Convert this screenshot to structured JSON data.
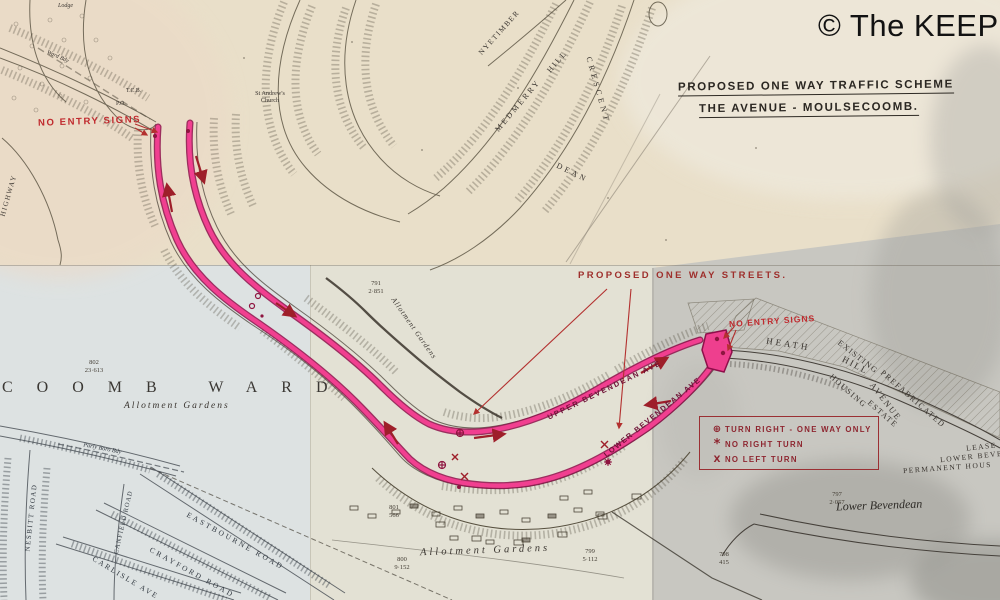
{
  "watermark": {
    "text": "© The KEEP"
  },
  "title": {
    "line1": "PROPOSED ONE WAY TRAFFIC SCHEME",
    "line2": "THE AVENUE - MOULSECOOMB."
  },
  "annotations": {
    "no_entry_left": "NO ENTRY SIGNS",
    "no_entry_right": "NO ENTRY SIGNS",
    "proposed_streets": "PROPOSED ONE WAY STREETS.",
    "route_upper": "UPPER BEVENDEAN AVE",
    "route_lower": "LOWER BEVENDEAN AVE"
  },
  "legend": {
    "items": [
      {
        "symbol": "⊕",
        "label": "TURN RIGHT - ONE WAY ONLY"
      },
      {
        "symbol": "*",
        "label": "NO RIGHT TURN"
      },
      {
        "symbol": "X",
        "label": "NO LEFT TURN"
      }
    ]
  },
  "map_labels": {
    "ward": "COOMB WARD",
    "allotment_ward": "Allotment Gardens",
    "allotment_bottom": "Allotment Gardens",
    "allotment_mid": "Allotment Gardens",
    "lower_bevendean": "Lower Bevendean",
    "permanent_housing": "PERMANENT HOUS",
    "lower_bev_partial": "LOWER BEVE",
    "lease_partial": "LEASE",
    "heath": "HEATH",
    "hill2": "HILL",
    "avenue": "AVENUE",
    "existing": "EXISTING",
    "prefabricated": "PREFABRICATED",
    "housing": "HOUSING",
    "estate": "ESTATE",
    "medmerry": "MEDMERRY",
    "hill1": "HILL",
    "crescent": "CRESCENT",
    "nyetimber": "NYETIMBER",
    "dean": "DEAN",
    "church1": "St Andrew's",
    "church2": "Church",
    "highway": "HIGHWAY",
    "nesbitt": "NESBITT ROAD",
    "canfield": "CANFIELD ROAD",
    "eastbourne": "EASTBOURNE ROAD",
    "crayford": "CRAYFORD ROAD",
    "carlisle": "CARLISLE AVE",
    "parly": "Parly Boro Bdy",
    "ward_bdy": "Ward Bdy",
    "tcb": "T.C.B.",
    "po": "P.O.",
    "lodge": "Lodge"
  },
  "parcels": [
    {
      "num": "791",
      "area": "2·851"
    },
    {
      "num": "802",
      "area": "23·613"
    },
    {
      "num": "800",
      "area": "9·152"
    },
    {
      "num": "799",
      "area": "5·112"
    },
    {
      "num": "797",
      "area": "2·057"
    },
    {
      "num": "798",
      "area": "415"
    },
    {
      "num": "801",
      "area": "566"
    }
  ],
  "colors": {
    "route_pink": "#ee3f8e",
    "route_edge": "#8e0f4a",
    "annotation_red": "#c02a2e",
    "legend_red": "#8e2630",
    "paper_cream": "#e9e0cc",
    "paper_blue": "#dde2e2",
    "paper_grey": "#c8c7c1"
  }
}
